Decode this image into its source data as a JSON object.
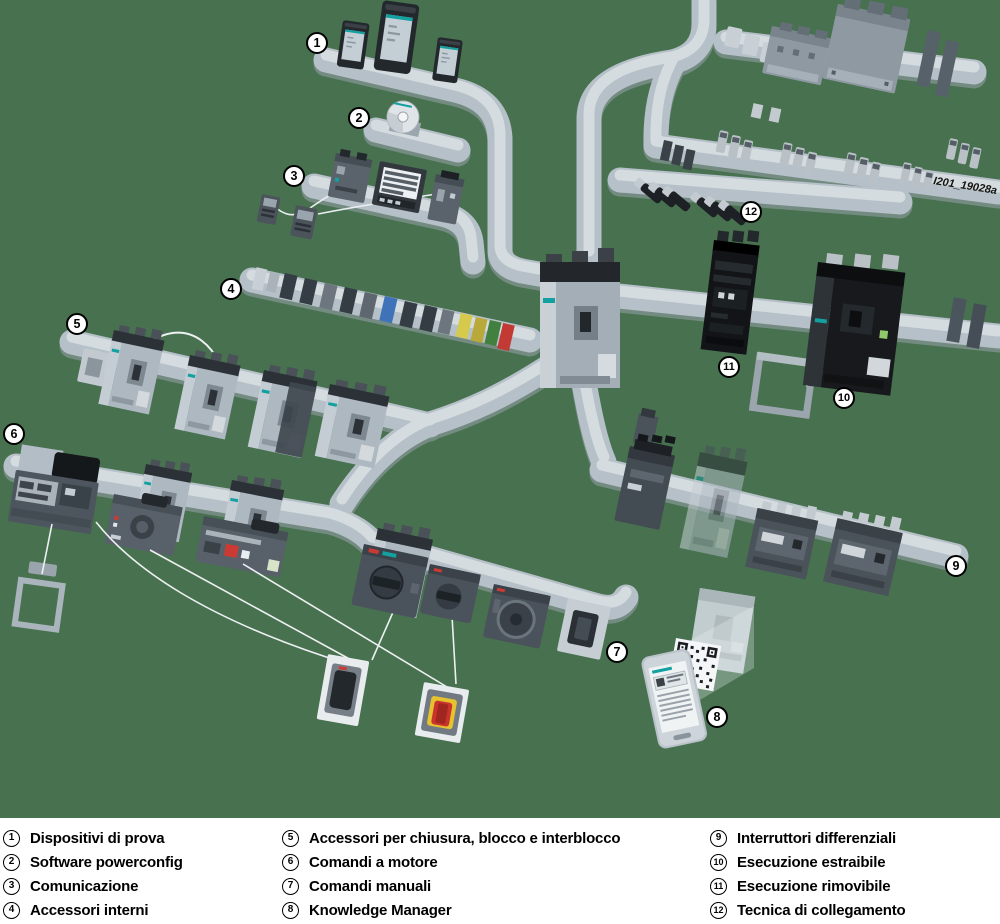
{
  "legend": {
    "items": [
      {
        "num": "1",
        "label": "Dispositivi di prova"
      },
      {
        "num": "2",
        "label": "Software powerconfig"
      },
      {
        "num": "3",
        "label": "Comunicazione"
      },
      {
        "num": "4",
        "label": "Accessori interni"
      },
      {
        "num": "5",
        "label": "Accessori per chiusura, blocco e interblocco"
      },
      {
        "num": "6",
        "label": "Comandi a motore"
      },
      {
        "num": "7",
        "label": "Comandi manuali"
      },
      {
        "num": "8",
        "label": "Knowledge Manager"
      },
      {
        "num": "9",
        "label": "Interruttori differenziali"
      },
      {
        "num": "10",
        "label": "Esecuzione estraibile"
      },
      {
        "num": "11",
        "label": "Esecuzione rimovibile"
      },
      {
        "num": "12",
        "label": "Tecnica di collegamento"
      }
    ]
  },
  "diagram": {
    "watermark": "I201_19028a",
    "callouts": [
      "1",
      "2",
      "3",
      "4",
      "5",
      "6",
      "7",
      "8",
      "9",
      "10",
      "11",
      "12"
    ]
  },
  "colors": {
    "background_green": "#47714f",
    "legend_background": "#ffffff",
    "rail": "#b6c0c8",
    "rail_highlight": "#d5dce0",
    "device_dark": "#23282d",
    "breaker_light": "#adb8c1",
    "breaker_black": "#17191c",
    "accent_teal": "#12a0a0",
    "accent_red": "#c8342c",
    "accent_yellow": "#e6c22f",
    "accent_blue": "#3f72b8",
    "accent_green_module": "#41803f"
  }
}
